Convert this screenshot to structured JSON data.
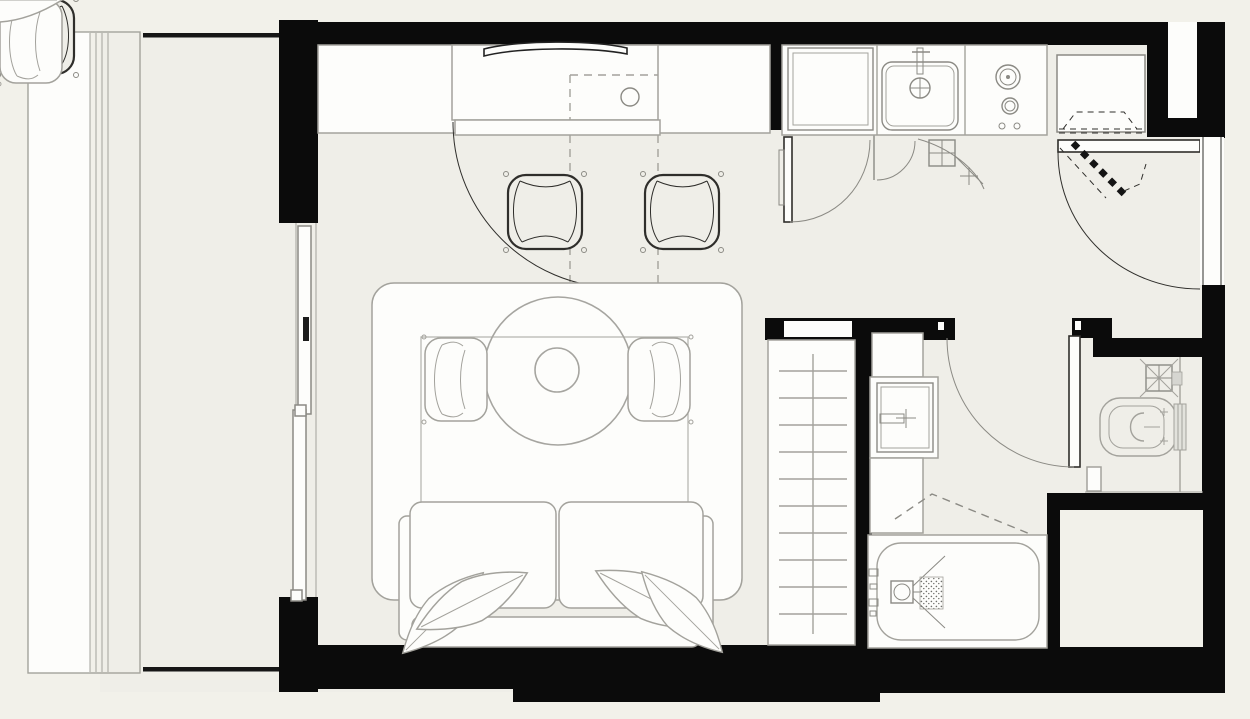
{
  "title": "studio-apartment-floor-plan",
  "colors": {
    "bg": "#f2f1ea",
    "floor": "#efeee8",
    "wall": "#0b0b0b",
    "white": "#fdfdfb",
    "lineL": "#a3a29c",
    "lineM": "#8b8a84",
    "lineD": "#2f2e2b",
    "tank": "#e2e2dc",
    "accessory": "#d6d6d1"
  },
  "rooms": [
    {
      "name": "living-area"
    },
    {
      "name": "kitchen"
    },
    {
      "name": "entry-hall"
    },
    {
      "name": "bathroom"
    },
    {
      "name": "staircase"
    },
    {
      "name": "balcony"
    },
    {
      "name": "shaft-void"
    }
  ],
  "fixtures": [
    "balcony-glazing",
    "sliding-glass-door",
    "kitchen-counter",
    "wall-tv",
    "desk-counter",
    "desk-lamp-circle",
    "upper-cabinet-dashed",
    "bar-chair",
    "tall-cabinet",
    "utility-door",
    "floor-drain-grid",
    "kitchen-sink",
    "faucet",
    "gas-cooktop",
    "burner",
    "control-knob",
    "entry-closet",
    "entrance-door",
    "door-swing-arc",
    "threshold-hatch",
    "side-window",
    "stairs",
    "stair-treads",
    "bathroom-door",
    "vanity",
    "bathroom-sink",
    "under-sink-cabinet",
    "bathtub",
    "shower-head",
    "drain-mat",
    "ceiling-slope-dashed",
    "toilet",
    "cistern",
    "wall-grid-box",
    "waste-bin",
    "rug",
    "round-dining-table",
    "table-centerpiece",
    "dining-zone-rect",
    "armchair",
    "sofa",
    "sofa-cushion",
    "sofa-armrest",
    "leaf-pillow"
  ]
}
